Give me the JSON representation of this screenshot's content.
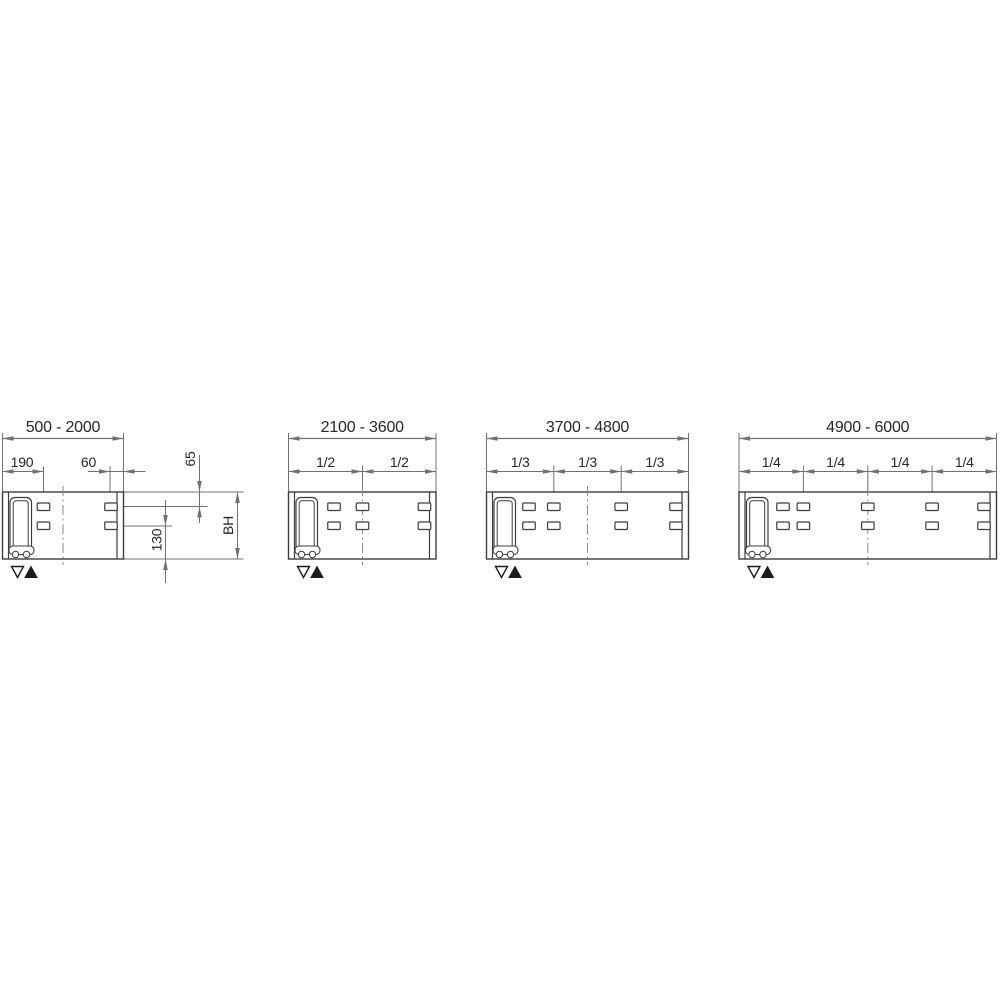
{
  "drawing": {
    "type": "technical-dimension-diagram",
    "description": "Four sliding-panel width variants with hole-pattern dimensioning",
    "colors": {
      "background": "#ffffff",
      "outline": "#3d3d3d",
      "dimension": "#707070",
      "text": "#262626",
      "centerline": "#8a8a8a",
      "triangle": "#1c1c1c"
    },
    "icons": {
      "down_symbol": "open-triangle-down",
      "up_symbol": "filled-triangle-up"
    },
    "layout": {
      "ext_top": 433,
      "range_dim_y": 438.5,
      "range_label_y": 432,
      "frac_dim_y": 471.5,
      "frac_label_y": 467,
      "panel_top": 492,
      "panel_bottom": 559,
      "slot_row1": 503,
      "slot_row2": 522,
      "slot_w": 12.5,
      "slot_h": 7.5,
      "cap_left_w": 6,
      "cap_right_w": 6.5,
      "centerline_top": 486,
      "centerline_bottom": 565,
      "tri_y": 566.5,
      "tri_w": 12,
      "tri_h": 11,
      "tri_dx_open": 9,
      "tri_dx_filled": 22.5
    },
    "panels": [
      {
        "id": "panel-500-2000",
        "range": "500 - 2000",
        "left": 2.5,
        "right": 123.5,
        "center": 63,
        "ticks": [],
        "fractions": [],
        "slot_columns": [
          43.5,
          111
        ],
        "sub_dims": [
          {
            "label": "190",
            "from": 2.5,
            "to": 43.5,
            "style": "inside",
            "label_x": 22
          },
          {
            "label": "60",
            "from": 110,
            "to": 123.5,
            "style": "outside",
            "label_x": 88.5,
            "tail": 22
          }
        ],
        "sub_ext_lines": [
          {
            "x": 43.5,
            "y1": 466.5,
            "y2": 503
          },
          {
            "x": 110,
            "y1": 466.5,
            "y2": 503
          }
        ],
        "h_ext_lines": [
          {
            "y": 492,
            "x1": 123.5,
            "x2": 243.5
          },
          {
            "y": 506.5,
            "x1": 117,
            "x2": 207.5
          },
          {
            "y": 526,
            "x1": 117,
            "x2": 172
          },
          {
            "y": 559,
            "x1": 123.5,
            "x2": 243.5
          }
        ],
        "v_dims": [
          {
            "label": "65",
            "x": 199.5,
            "from": 492,
            "to": 506.5,
            "style": "outside",
            "line_y1": 455,
            "line_y2": 523,
            "anchor_x": 195,
            "anchor_y": 459
          },
          {
            "label": "130",
            "x": 165.5,
            "from": 526,
            "to": 559,
            "style": "outside",
            "line_y1": 500,
            "line_y2": 583,
            "anchor_x": 161.5,
            "anchor_y": 540
          },
          {
            "label": "BH",
            "x": 237.5,
            "from": 492,
            "to": 559,
            "style": "inside",
            "anchor_x": 233,
            "anchor_y": 525.5
          }
        ]
      },
      {
        "id": "panel-2100-3600",
        "range": "2100 - 3600",
        "left": 288.5,
        "right": 436,
        "center": 362.5,
        "ticks": [
          362.5
        ],
        "fractions": [
          "1/2",
          "1/2"
        ],
        "slot_columns": [
          334,
          362.5,
          424.5
        ],
        "sub_dims": [],
        "sub_ext_lines": [],
        "h_ext_lines": [],
        "v_dims": []
      },
      {
        "id": "panel-3700-4800",
        "range": "3700 - 4800",
        "left": 486.5,
        "right": 688.5,
        "center": 587.5,
        "ticks": [
          553.8,
          621.2
        ],
        "fractions": [
          "1/3",
          "1/3",
          "1/3"
        ],
        "slot_columns": [
          529,
          553.8,
          621.2,
          676
        ],
        "sub_dims": [],
        "sub_ext_lines": [],
        "h_ext_lines": [],
        "v_dims": []
      },
      {
        "id": "panel-4900-6000",
        "range": "4900 - 6000",
        "left": 739,
        "right": 996.5,
        "center": 867.8,
        "ticks": [
          803.4,
          867.8,
          932.1
        ],
        "fractions": [
          "1/4",
          "1/4",
          "1/4",
          "1/4"
        ],
        "slot_columns": [
          783,
          803.4,
          867.8,
          932.1,
          984
        ],
        "sub_dims": [],
        "sub_ext_lines": [],
        "h_ext_lines": [],
        "v_dims": []
      }
    ]
  }
}
